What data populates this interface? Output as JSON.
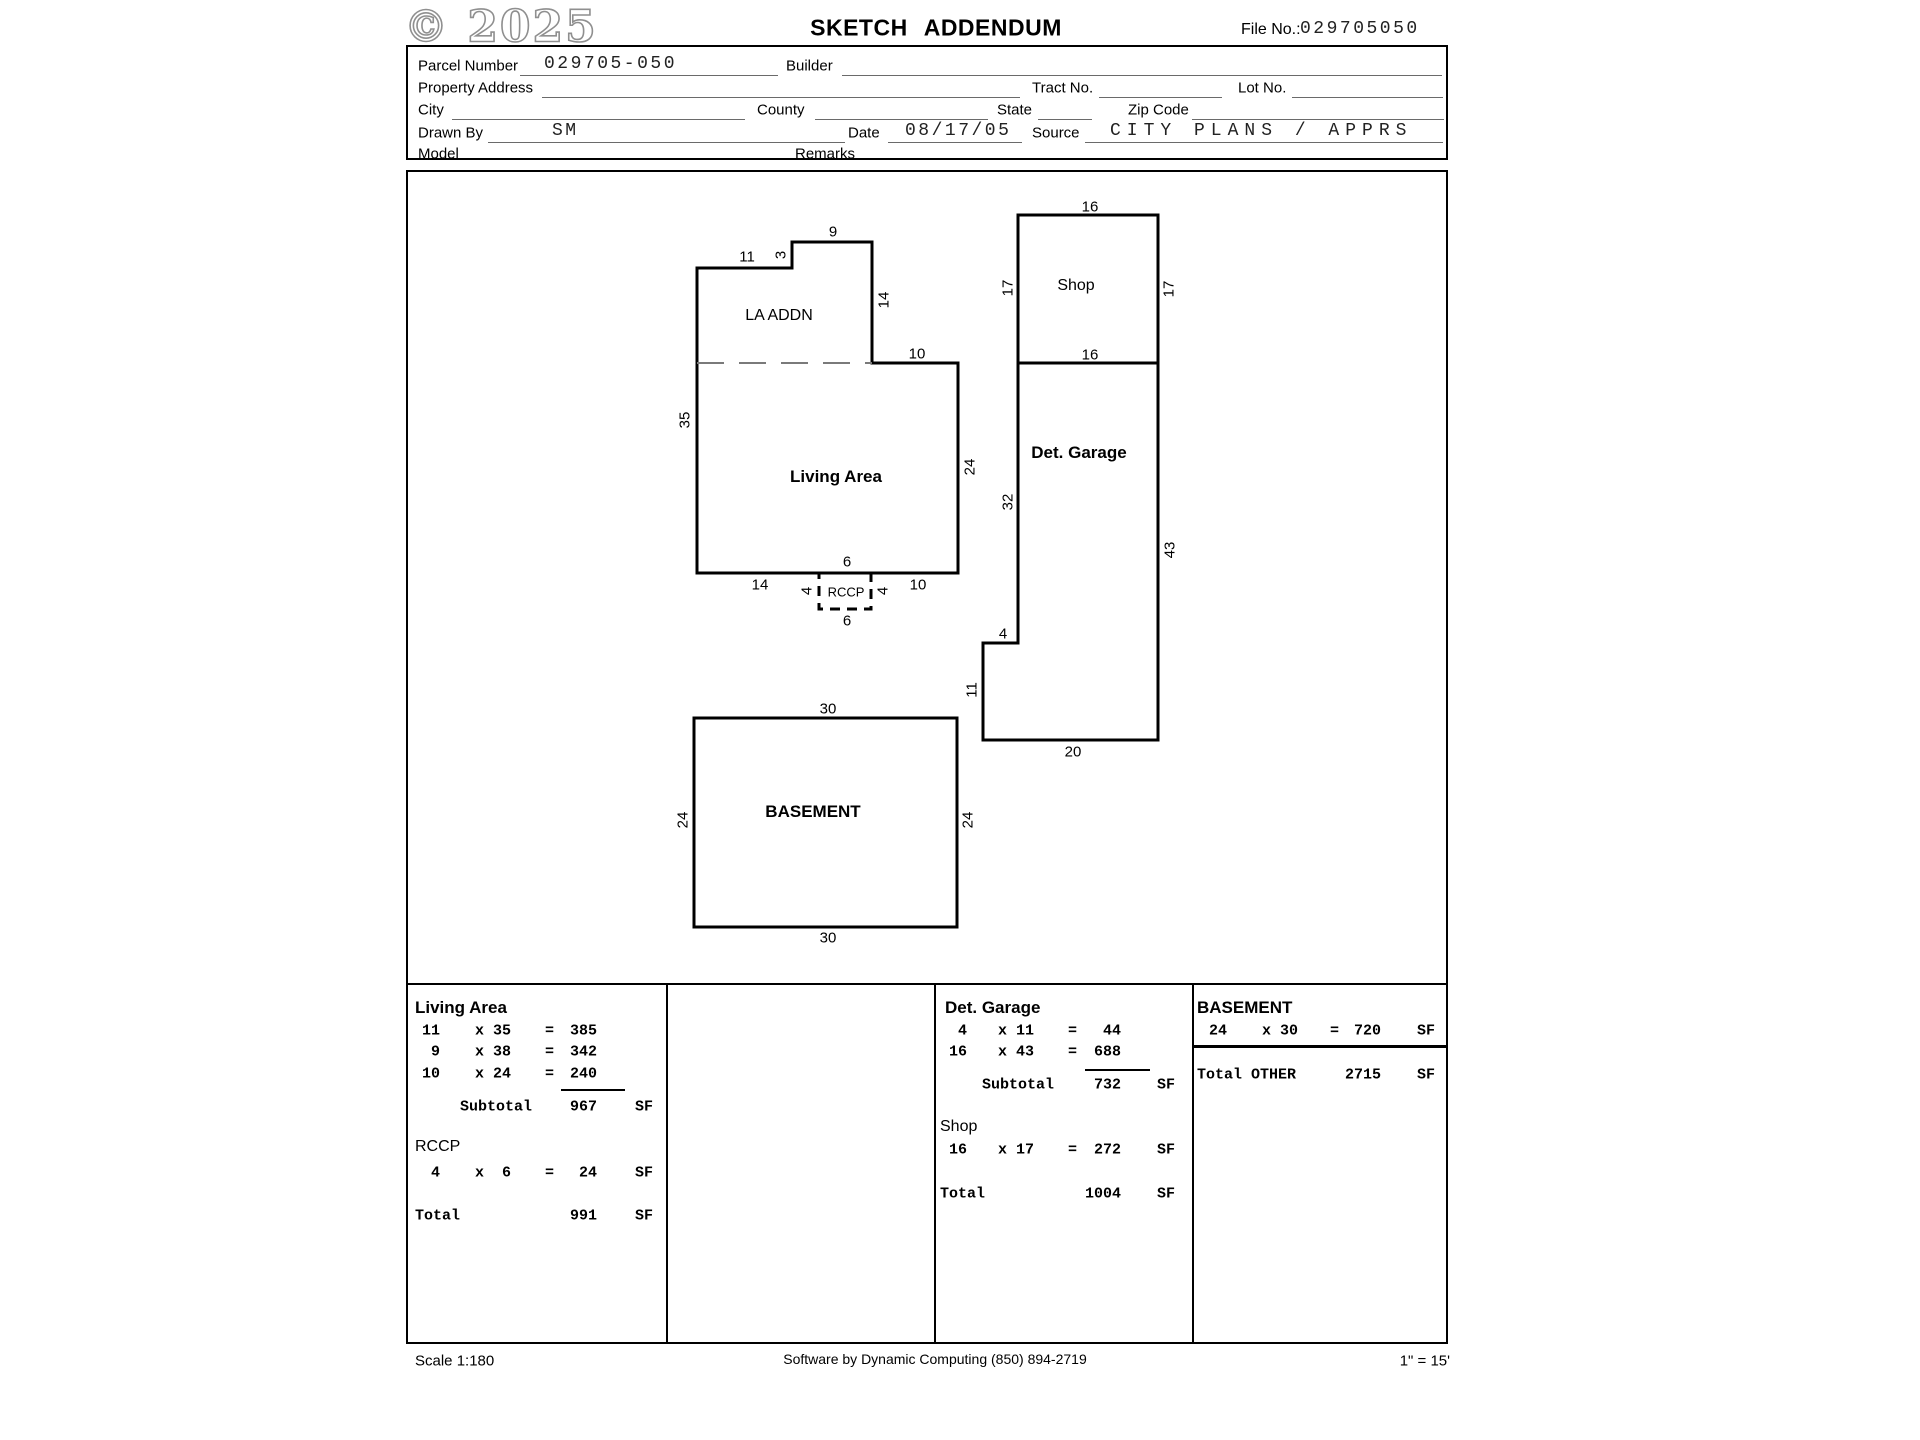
{
  "header": {
    "watermark": "© 2025",
    "title": "SKETCH ADDENDUM",
    "file_no_label": "File No.:",
    "file_no_value": "029705050"
  },
  "form": {
    "parcel_number_label": "Parcel Number",
    "parcel_number_value": "029705-050",
    "builder_label": "Builder",
    "property_address_label": "Property Address",
    "tract_no_label": "Tract No.",
    "lot_no_label": "Lot No.",
    "city_label": "City",
    "county_label": "County",
    "state_label": "State",
    "zip_code_label": "Zip Code",
    "drawn_by_label": "Drawn By",
    "drawn_by_value": "SM",
    "date_label": "Date",
    "date_value": "08/17/05",
    "source_label": "Source",
    "source_value": "CITY PLANS / APPRS",
    "model_label": "Model",
    "remarks_label": "Remarks"
  },
  "sketch": {
    "labels": [
      {
        "text": "11",
        "x": 747,
        "y": 257,
        "kind": "dim"
      },
      {
        "text": "3",
        "x": 781,
        "y": 255,
        "kind": "dim",
        "rot": true
      },
      {
        "text": "9",
        "x": 833,
        "y": 232,
        "kind": "dim"
      },
      {
        "text": "14",
        "x": 884,
        "y": 300,
        "kind": "dim",
        "rot": true
      },
      {
        "text": "10",
        "x": 917,
        "y": 354,
        "kind": "dim"
      },
      {
        "text": "35",
        "x": 685,
        "y": 420,
        "kind": "dim",
        "rot": true
      },
      {
        "text": "24",
        "x": 970,
        "y": 467,
        "kind": "dim",
        "rot": true
      },
      {
        "text": "LA ADDN",
        "x": 779,
        "y": 316,
        "kind": "room"
      },
      {
        "text": "Living Area",
        "x": 836,
        "y": 477,
        "kind": "room-bold"
      },
      {
        "text": "6",
        "x": 847,
        "y": 562,
        "kind": "dim"
      },
      {
        "text": "14",
        "x": 760,
        "y": 585,
        "kind": "dim"
      },
      {
        "text": "4",
        "x": 807,
        "y": 591,
        "kind": "dim",
        "rot": true
      },
      {
        "text": "RCCP",
        "x": 846,
        "y": 592,
        "kind": "room-small"
      },
      {
        "text": "4",
        "x": 883,
        "y": 591,
        "kind": "dim",
        "rot": true
      },
      {
        "text": "10",
        "x": 918,
        "y": 585,
        "kind": "dim"
      },
      {
        "text": "6",
        "x": 847,
        "y": 621,
        "kind": "dim"
      },
      {
        "text": "16",
        "x": 1090,
        "y": 207,
        "kind": "dim"
      },
      {
        "text": "17",
        "x": 1008,
        "y": 288,
        "kind": "dim",
        "rot": true
      },
      {
        "text": "Shop",
        "x": 1076,
        "y": 286,
        "kind": "room"
      },
      {
        "text": "17",
        "x": 1169,
        "y": 289,
        "kind": "dim",
        "rot": true
      },
      {
        "text": "16",
        "x": 1090,
        "y": 355,
        "kind": "dim"
      },
      {
        "text": "Det. Garage",
        "x": 1079,
        "y": 453,
        "kind": "room-bold"
      },
      {
        "text": "32",
        "x": 1008,
        "y": 502,
        "kind": "dim",
        "rot": true
      },
      {
        "text": "43",
        "x": 1170,
        "y": 550,
        "kind": "dim",
        "rot": true
      },
      {
        "text": "4",
        "x": 1003,
        "y": 634,
        "kind": "dim"
      },
      {
        "text": "11",
        "x": 972,
        "y": 690,
        "kind": "dim",
        "rot": true
      },
      {
        "text": "20",
        "x": 1073,
        "y": 752,
        "kind": "dim"
      },
      {
        "text": "30",
        "x": 828,
        "y": 709,
        "kind": "dim"
      },
      {
        "text": "24",
        "x": 683,
        "y": 820,
        "kind": "dim",
        "rot": true
      },
      {
        "text": "BASEMENT",
        "x": 813,
        "y": 812,
        "kind": "room-bold"
      },
      {
        "text": "24",
        "x": 968,
        "y": 820,
        "kind": "dim",
        "rot": true
      },
      {
        "text": "30",
        "x": 828,
        "y": 938,
        "kind": "dim"
      }
    ]
  },
  "tables": {
    "living_area": {
      "title": "Living Area",
      "rows": [
        [
          "11",
          "x 35",
          "=",
          "385",
          ""
        ],
        [
          "9",
          "x 38",
          "=",
          "342",
          ""
        ],
        [
          "10",
          "x 24",
          "=",
          "240",
          ""
        ]
      ],
      "subtotal": [
        "Subtotal",
        "967",
        "SF"
      ],
      "section2": "RCCP",
      "rows2": [
        [
          "4",
          "x  6",
          "=",
          "24",
          "SF"
        ]
      ],
      "total": [
        "Total",
        "991",
        "SF"
      ]
    },
    "det_garage": {
      "title": "Det. Garage",
      "rows": [
        [
          "4",
          "x 11",
          "=",
          "44",
          ""
        ],
        [
          "16",
          "x 43",
          "=",
          "688",
          ""
        ]
      ],
      "subtotal": [
        "Subtotal",
        "732",
        "SF"
      ],
      "section2": "Shop",
      "rows2": [
        [
          "16",
          "x 17",
          "=",
          "272",
          "SF"
        ]
      ],
      "total": [
        "Total",
        "1004",
        "SF"
      ]
    },
    "basement": {
      "title": "BASEMENT",
      "rows": [
        [
          "24",
          "x 30",
          "=",
          "720",
          "SF"
        ]
      ],
      "total": [
        "Total OTHER",
        "2715",
        "SF"
      ]
    }
  },
  "footer": {
    "scale_left": "Scale 1:180",
    "software": "Software by Dynamic Computing (850) 894-2719",
    "scale_right": "1\" = 15'"
  }
}
